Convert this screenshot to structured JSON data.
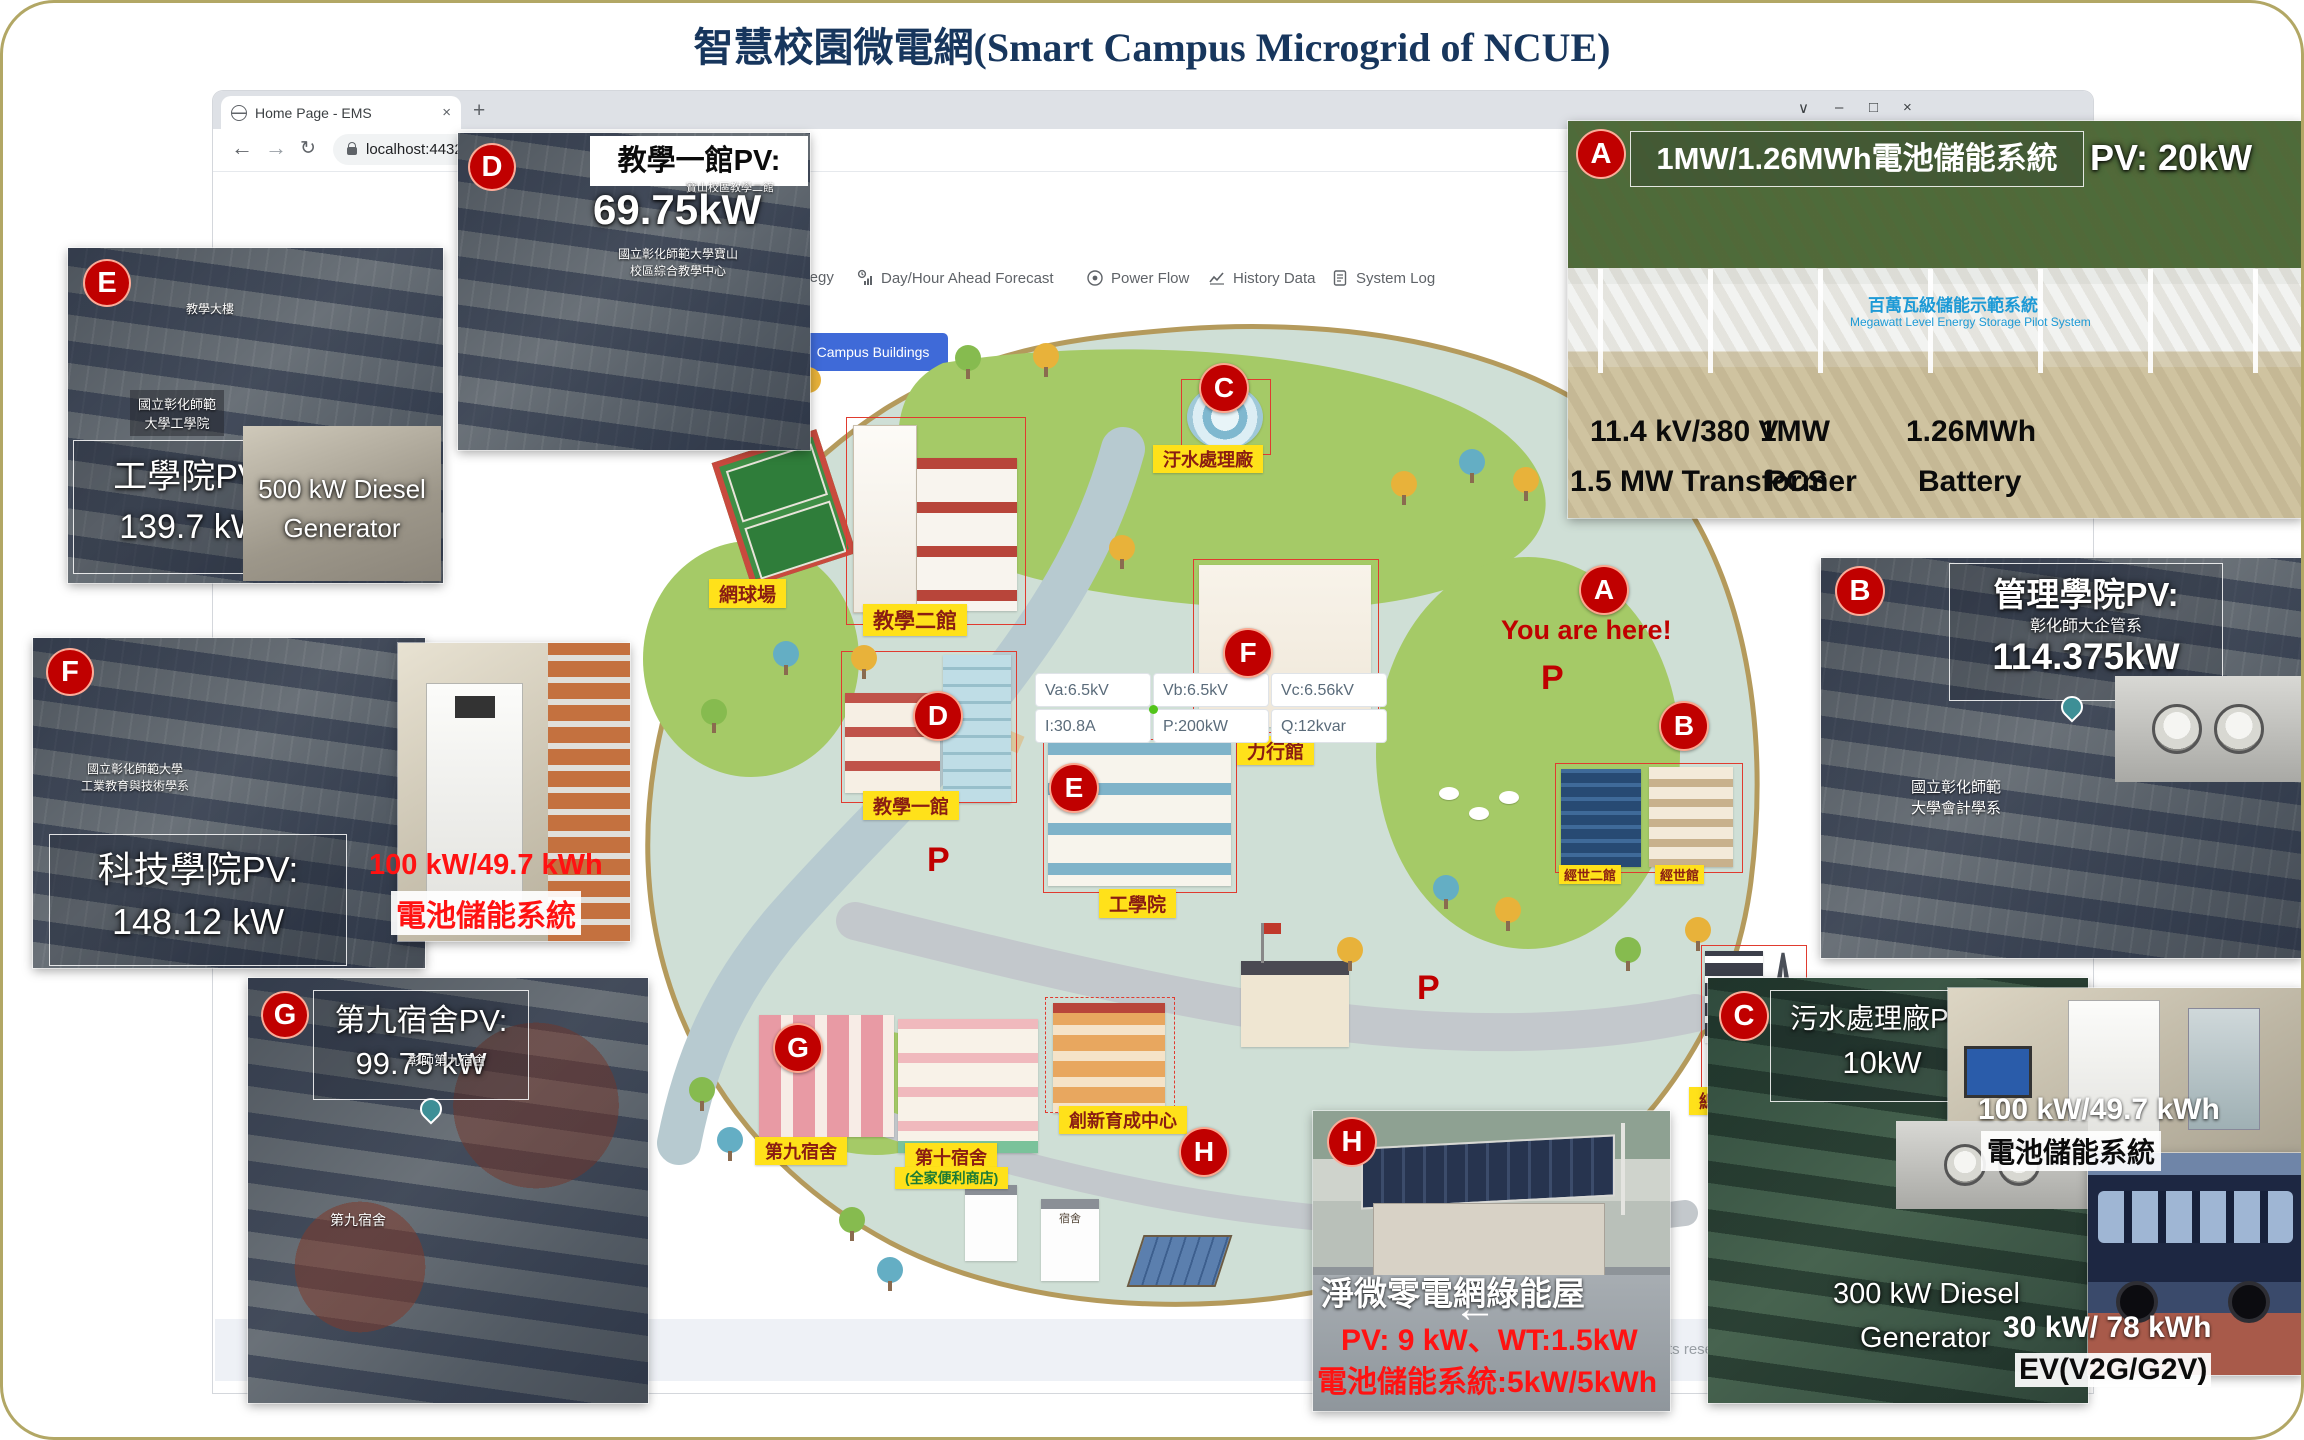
{
  "title": "智慧校園微電網(Smart Campus Microgrid of NCUE)",
  "browser": {
    "tab_title": "Home Page - EMS",
    "tab_close": "×",
    "new_tab": "+",
    "back": "←",
    "forward": "→",
    "reload": "↻",
    "url": "localhost:44323/H",
    "ctrl_menu": "∨",
    "ctrl_min": "–",
    "ctrl_max": "□",
    "ctrl_close": "×"
  },
  "nav": {
    "strategy": "Strategy",
    "forecast": "Day/Hour Ahead Forecast",
    "power_flow": "Power Flow",
    "history": "History Data",
    "syslog": "System Log"
  },
  "campus_buildings": "Campus Buildings",
  "map": {
    "labels": {
      "tennis": "網球場",
      "teaching2": "教學二館",
      "teaching1": "教學一館",
      "sewage": "汙水處理廠",
      "lixing": "力行館",
      "engineering": "工學院",
      "dorm9": "第九宿舍",
      "dorm10": "第十宿舍",
      "dorm10_sub": "(全家便利商店)",
      "incubation": "創新育成中心",
      "substation": "總變電站",
      "bldg_b1": "經世二館",
      "bldg_b2": "經世館",
      "hut": "宿舍"
    },
    "markers": {
      "a": "A",
      "b": "B",
      "c": "C",
      "d": "D",
      "e": "E",
      "f": "F",
      "g": "G",
      "h": "H"
    },
    "you_are_here": "You are here!",
    "parking": "P",
    "tooltip": {
      "va": "Va:6.5kV",
      "vb": "Vb:6.5kV",
      "vc": "Vc:6.56kV",
      "i": "I:30.8A",
      "p": "P:200kW",
      "q": "Q:12kvar"
    }
  },
  "callouts": {
    "a": {
      "title": "1MW/1.26MWh電池儲能系統",
      "pv": "PV: 20kW",
      "banner_zh": "百萬瓦級儲能示範系統",
      "banner_en": "Megawatt Level Energy Storage Pilot System",
      "spec1a": "11.4 kV/380 V",
      "spec1b": "1.5 MW Transformer",
      "spec2a": "1MW",
      "spec2b": "PCS",
      "spec3a": "1.26MWh",
      "spec3b": "Battery"
    },
    "b": {
      "title": "管理學院PV:",
      "value": "114.375kW",
      "tag": "彰化師大企管系",
      "small1": "國立彰化師範",
      "small2": "大學會計學系"
    },
    "c": {
      "title": "污水處理廠PV:",
      "value": "10kW",
      "diesel1": "300 kW Diesel",
      "diesel2": "Generator",
      "batt": "100 kW/49.7 kWh",
      "batt_label": "電池儲能系統",
      "ev": "30 kW/ 78 kWh",
      "ev_label": "EV(V2G/G2V)"
    },
    "d": {
      "title": "教學一館PV:",
      "value": "69.75kW",
      "tag": "寶山校區教學二館",
      "small1": "國立彰化師範大學寶山",
      "small2": "校區綜合教學中心"
    },
    "e": {
      "title": "工學院PV:",
      "value": "139.7 kW",
      "roof": "教學大樓",
      "small1": "國立彰化師範",
      "small2": "大學工學院",
      "diesel1": "500 kW Diesel",
      "diesel2": "Generator"
    },
    "f": {
      "title": "科技學院PV:",
      "value": "148.12 kW",
      "batt": "100 kW/49.7 kWh",
      "batt_label": "電池儲能系統",
      "small1": "國立彰化師範大學",
      "small2": "工業教育與技術學系"
    },
    "g": {
      "title": "第九宿舍PV:",
      "value": "99.75 kW",
      "tag": "彰師第九宿舍",
      "small1": "第九宿舍"
    },
    "h": {
      "title": "淨微零電網綠能屋",
      "line1": "PV: 9 kW、WT:1.5kW",
      "line2": "電池儲能系統:5kW/5kWh"
    }
  },
  "footer": {
    "rights": "rights reserved."
  }
}
